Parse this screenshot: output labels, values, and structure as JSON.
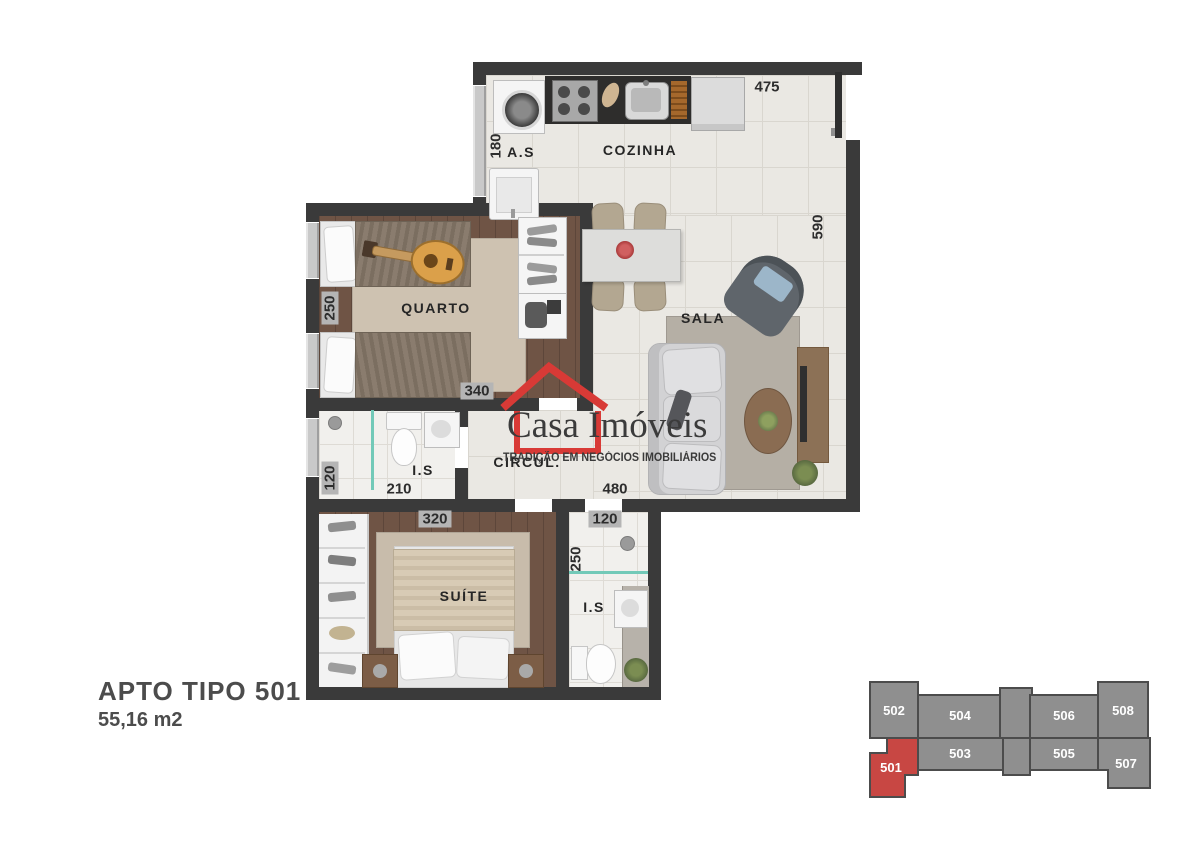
{
  "plan": {
    "rooms": {
      "as": {
        "label": "A.S"
      },
      "cozinha": {
        "label": "COZINHA"
      },
      "sala": {
        "label": "SALA"
      },
      "quarto": {
        "label": "QUARTO"
      },
      "is1": {
        "label": "I.S"
      },
      "circul": {
        "label": "CIRCUL."
      },
      "suite": {
        "label": "SUÍTE"
      },
      "is2": {
        "label": "I.S"
      }
    },
    "dims": {
      "cozinha_width": "475",
      "as_depth": "180",
      "sala_height": "590",
      "quarto_height": "250",
      "quarto_width": "340",
      "is1_height": "120",
      "is1_width": "210",
      "circul_width": "480",
      "suite_width": "320",
      "is2_width": "120",
      "is2_height": "250"
    }
  },
  "logo": {
    "word1": "Casa",
    "word2": "Imóveis",
    "tagline": "TRADIÇÃO EM NEGÓCIOS IMOBILIÁRIOS"
  },
  "title": {
    "name": "APTO TIPO 501",
    "area": "55,16 m2"
  },
  "keyplan": {
    "highlighted_unit": "501",
    "units": [
      {
        "number": "502",
        "highlighted": false
      },
      {
        "number": "504",
        "highlighted": false
      },
      {
        "number": "506",
        "highlighted": false
      },
      {
        "number": "508",
        "highlighted": false
      },
      {
        "number": "501",
        "highlighted": true
      },
      {
        "number": "503",
        "highlighted": false
      },
      {
        "number": "505",
        "highlighted": false
      },
      {
        "number": "507",
        "highlighted": false
      }
    ]
  },
  "colors": {
    "wall": "#3a3a3a",
    "accent_red": "#d83a36",
    "keyplan_red": "#c84743",
    "keyplan_gray": "#8f8f8f",
    "glass_teal": "#72c9b8"
  }
}
